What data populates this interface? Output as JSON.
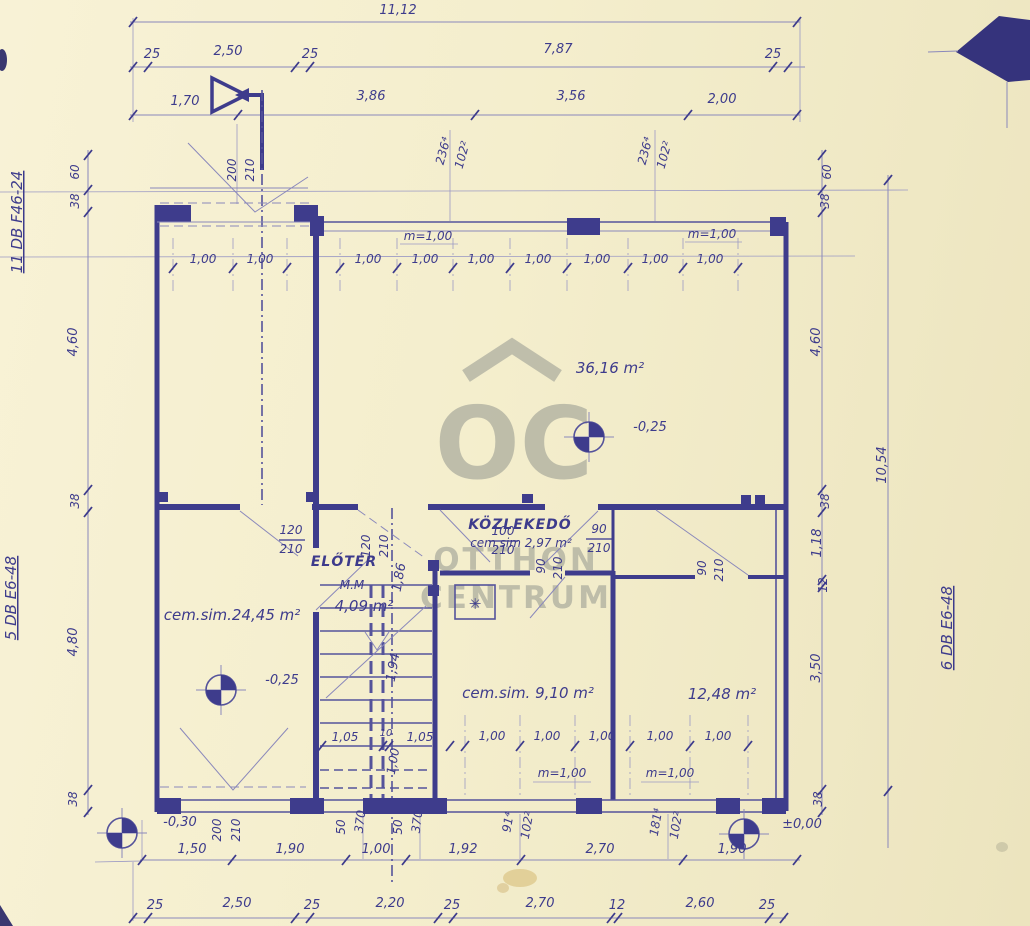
{
  "colors": {
    "paper": "#f4eecd",
    "ink": "#3e3c8c",
    "ink_light": "#8a88bb",
    "watermark_gray": "#b5b5a4"
  },
  "watermark": {
    "monogram": "OC",
    "word1": "OTTHON",
    "word2": "CENTRUM"
  },
  "annotations": {
    "side_left_top": "11 DB F46-24",
    "side_left_bottom": "5 DB E6-48",
    "side_right": "6 DB E6-48"
  },
  "plan": {
    "texts": [
      {
        "t": "11,12",
        "x": 398,
        "y": 14
      },
      {
        "t": "25",
        "x": 152,
        "y": 58
      },
      {
        "t": "2,50",
        "x": 228,
        "y": 55
      },
      {
        "t": "25",
        "x": 310,
        "y": 58
      },
      {
        "t": "7,87",
        "x": 558,
        "y": 53
      },
      {
        "t": "25",
        "x": 773,
        "y": 58
      },
      {
        "t": "1,70",
        "x": 185,
        "y": 105
      },
      {
        "t": "3,86",
        "x": 371,
        "y": 100
      },
      {
        "t": "3,56",
        "x": 571,
        "y": 100
      },
      {
        "t": "2,00",
        "x": 722,
        "y": 103
      },
      {
        "t": "200",
        "x": 236,
        "y": 170,
        "r": -90,
        "cls": "sm"
      },
      {
        "t": "210",
        "x": 254,
        "y": 170,
        "r": -90,
        "cls": "sm"
      },
      {
        "t": "236⁴",
        "x": 447,
        "y": 152,
        "r": -75,
        "cls": "sm"
      },
      {
        "t": "102²",
        "x": 466,
        "y": 156,
        "r": -75,
        "cls": "sm"
      },
      {
        "t": "236⁴",
        "x": 649,
        "y": 152,
        "r": -75,
        "cls": "sm"
      },
      {
        "t": "102²",
        "x": 668,
        "y": 156,
        "r": -75,
        "cls": "sm"
      },
      {
        "t": "60",
        "x": 79,
        "y": 172,
        "r": -90,
        "cls": "sm"
      },
      {
        "t": "38",
        "x": 79,
        "y": 201,
        "r": -90,
        "cls": "sm"
      },
      {
        "t": "4,60",
        "x": 77,
        "y": 342,
        "r": -90
      },
      {
        "t": "38",
        "x": 79,
        "y": 501,
        "r": -90,
        "cls": "sm"
      },
      {
        "t": "4,80",
        "x": 77,
        "y": 642,
        "r": -90
      },
      {
        "t": "38",
        "x": 77,
        "y": 799,
        "r": -90,
        "cls": "sm"
      },
      {
        "t": "60",
        "x": 831,
        "y": 172,
        "r": -90,
        "cls": "sm"
      },
      {
        "t": "38",
        "x": 829,
        "y": 201,
        "r": -90,
        "cls": "sm"
      },
      {
        "t": "4,60",
        "x": 820,
        "y": 342,
        "r": -90
      },
      {
        "t": "38",
        "x": 829,
        "y": 501,
        "r": -90,
        "cls": "sm"
      },
      {
        "t": "1,18",
        "x": 821,
        "y": 543,
        "r": -90
      },
      {
        "t": "12",
        "x": 827,
        "y": 585,
        "r": -90,
        "cls": "sm"
      },
      {
        "t": "3,50",
        "x": 820,
        "y": 668,
        "r": -90
      },
      {
        "t": "38",
        "x": 822,
        "y": 799,
        "r": -90,
        "cls": "sm"
      },
      {
        "t": "10,54",
        "x": 886,
        "y": 465,
        "r": -90
      },
      {
        "t": "m=1,00",
        "x": 428,
        "y": 240,
        "cls": "sm"
      },
      {
        "t": "m=1,00",
        "x": 712,
        "y": 238,
        "cls": "sm"
      },
      {
        "t": "1,00",
        "x": 203,
        "y": 263,
        "cls": "sm"
      },
      {
        "t": "1,00",
        "x": 260,
        "y": 263,
        "cls": "sm"
      },
      {
        "t": "1,00",
        "x": 368,
        "y": 263,
        "cls": "sm"
      },
      {
        "t": "1,00",
        "x": 425,
        "y": 263,
        "cls": "sm"
      },
      {
        "t": "1,00",
        "x": 481,
        "y": 263,
        "cls": "sm"
      },
      {
        "t": "1,00",
        "x": 538,
        "y": 263,
        "cls": "sm"
      },
      {
        "t": "1,00",
        "x": 597,
        "y": 263,
        "cls": "sm"
      },
      {
        "t": "1,00",
        "x": 655,
        "y": 263,
        "cls": "sm"
      },
      {
        "t": "1,00",
        "x": 710,
        "y": 263,
        "cls": "sm"
      },
      {
        "t": "36,16 m²",
        "x": 610,
        "y": 373,
        "cls": "room"
      },
      {
        "t": "KÖZLEKEDŐ",
        "x": 520,
        "y": 529,
        "cls": "roomB"
      },
      {
        "t": "cem.sim 2,97 m²",
        "x": 521,
        "y": 547,
        "cls": "sm"
      },
      {
        "t": "90",
        "x": 599,
        "y": 533,
        "cls": "sm"
      },
      {
        "t": "210",
        "x": 599,
        "y": 552,
        "cls": "sm"
      },
      {
        "t": "100",
        "x": 503,
        "y": 535,
        "cls": "sm"
      },
      {
        "t": "210",
        "x": 503,
        "y": 554,
        "cls": "sm"
      },
      {
        "t": "120",
        "x": 291,
        "y": 534,
        "cls": "sm"
      },
      {
        "t": "210",
        "x": 291,
        "y": 553,
        "cls": "sm"
      },
      {
        "t": "ELŐTÉR",
        "x": 344,
        "y": 566,
        "cls": "roomB"
      },
      {
        "t": "120",
        "x": 370,
        "y": 546,
        "r": -90,
        "cls": "sm"
      },
      {
        "t": "210",
        "x": 388,
        "y": 546,
        "r": -90,
        "cls": "sm"
      },
      {
        "t": "90",
        "x": 545,
        "y": 566,
        "r": -90,
        "cls": "sm"
      },
      {
        "t": "210",
        "x": 562,
        "y": 568,
        "r": -90,
        "cls": "sm"
      },
      {
        "t": "90",
        "x": 706,
        "y": 568,
        "r": -90,
        "cls": "sm"
      },
      {
        "t": "210",
        "x": 723,
        "y": 570,
        "r": -90,
        "cls": "sm"
      },
      {
        "t": "1,86",
        "x": 403,
        "y": 578,
        "r": -80
      },
      {
        "t": "1,94",
        "x": 397,
        "y": 668,
        "r": -80
      },
      {
        "t": "1,00",
        "x": 397,
        "y": 762,
        "r": -80,
        "cls": "sm"
      },
      {
        "t": "M.M",
        "x": 352,
        "y": 589,
        "cls": "sm"
      },
      {
        "t": "4,09 m²",
        "x": 364,
        "y": 611,
        "cls": "room"
      },
      {
        "t": "cem.sim.24,45 m²",
        "x": 232,
        "y": 620,
        "cls": "room"
      },
      {
        "t": "cem.sim. 9,10 m²",
        "x": 528,
        "y": 698,
        "cls": "room"
      },
      {
        "t": "12,48 m²",
        "x": 722,
        "y": 699,
        "cls": "room"
      },
      {
        "t": "1,05",
        "x": 345,
        "y": 741,
        "cls": "sm"
      },
      {
        "t": "10",
        "x": 386,
        "y": 736,
        "cls": "xs"
      },
      {
        "t": "1,05",
        "x": 420,
        "y": 741,
        "cls": "sm"
      },
      {
        "t": "1,00",
        "x": 492,
        "y": 740,
        "cls": "sm"
      },
      {
        "t": "1,00",
        "x": 547,
        "y": 740,
        "cls": "sm"
      },
      {
        "t": "1,00",
        "x": 602,
        "y": 740,
        "cls": "sm"
      },
      {
        "t": "1,00",
        "x": 660,
        "y": 740,
        "cls": "sm"
      },
      {
        "t": "1,00",
        "x": 718,
        "y": 740,
        "cls": "sm"
      },
      {
        "t": "m=1,00",
        "x": 562,
        "y": 777,
        "cls": "sm"
      },
      {
        "t": "m=1,00",
        "x": 670,
        "y": 777,
        "cls": "sm"
      },
      {
        "t": "200",
        "x": 221,
        "y": 830,
        "r": -90,
        "cls": "sm"
      },
      {
        "t": "210",
        "x": 240,
        "y": 830,
        "r": -90,
        "cls": "sm"
      },
      {
        "t": "50",
        "x": 345,
        "y": 827,
        "r": -90,
        "cls": "sm"
      },
      {
        "t": "370",
        "x": 364,
        "y": 822,
        "r": -83,
        "cls": "sm"
      },
      {
        "t": "50",
        "x": 402,
        "y": 827,
        "r": -90,
        "cls": "sm"
      },
      {
        "t": "370",
        "x": 421,
        "y": 822,
        "r": -83,
        "cls": "sm"
      },
      {
        "t": "91⁴",
        "x": 512,
        "y": 823,
        "r": -80,
        "cls": "sm"
      },
      {
        "t": "102²",
        "x": 531,
        "y": 826,
        "r": -80,
        "cls": "sm"
      },
      {
        "t": "181⁴",
        "x": 660,
        "y": 823,
        "r": -80,
        "cls": "sm"
      },
      {
        "t": "102²",
        "x": 680,
        "y": 826,
        "r": -80,
        "cls": "sm"
      },
      {
        "t": "1,50",
        "x": 192,
        "y": 853
      },
      {
        "t": "1,90",
        "x": 290,
        "y": 853
      },
      {
        "t": "1,00",
        "x": 376,
        "y": 853
      },
      {
        "t": "1,92",
        "x": 463,
        "y": 853
      },
      {
        "t": "2,70",
        "x": 600,
        "y": 853
      },
      {
        "t": "1,90",
        "x": 732,
        "y": 853
      },
      {
        "t": "25",
        "x": 155,
        "y": 909
      },
      {
        "t": "2,50",
        "x": 237,
        "y": 907
      },
      {
        "t": "25",
        "x": 312,
        "y": 909
      },
      {
        "t": "2,20",
        "x": 390,
        "y": 907
      },
      {
        "t": "25",
        "x": 452,
        "y": 909
      },
      {
        "t": "2,70",
        "x": 540,
        "y": 907
      },
      {
        "t": "12",
        "x": 617,
        "y": 909
      },
      {
        "t": "2,60",
        "x": 700,
        "y": 907
      },
      {
        "t": "25",
        "x": 767,
        "y": 909
      },
      {
        "t": "✳",
        "x": 475,
        "y": 609,
        "cls": "sym"
      }
    ],
    "ticks": {
      "rows": [
        {
          "y": 22,
          "xs": [
            133,
            797
          ]
        },
        {
          "y": 67,
          "xs": [
            133,
            148,
            295,
            310,
            773,
            788
          ]
        },
        {
          "y": 115,
          "xs": [
            133,
            238,
            475,
            688,
            797
          ]
        },
        {
          "y": 268,
          "xs": [
            173,
            233,
            287,
            340,
            397,
            453,
            510,
            567,
            628,
            683,
            738
          ]
        },
        {
          "y": 746,
          "xs": [
            322,
            383,
            389,
            450,
            465,
            520,
            575,
            630,
            690,
            748
          ]
        },
        {
          "y": 860,
          "xs": [
            142,
            232,
            346,
            406,
            521,
            683,
            797
          ]
        },
        {
          "y": 918,
          "xs": [
            133,
            148,
            295,
            310,
            438,
            453,
            611,
            618,
            769,
            784
          ]
        }
      ],
      "cols": [
        {
          "x": 88,
          "ys": [
            155,
            190,
            212,
            490,
            512,
            790,
            812
          ]
        },
        {
          "x": 822,
          "ys": [
            155,
            190,
            212,
            490,
            512,
            580,
            587,
            790,
            812
          ]
        },
        {
          "x": 888,
          "ys": [
            180,
            791
          ]
        }
      ]
    },
    "levels": [
      {
        "x": 589,
        "y": 437,
        "t": "-0,25",
        "lx": 650,
        "ly": 431
      },
      {
        "x": 221,
        "y": 690,
        "t": "-0,25",
        "lx": 282,
        "ly": 684
      },
      {
        "x": 122,
        "y": 833,
        "t": "-0,30",
        "lx": 180,
        "ly": 826
      },
      {
        "x": 744,
        "y": 834,
        "t": "±0,00",
        "lx": 802,
        "ly": 828
      }
    ]
  }
}
